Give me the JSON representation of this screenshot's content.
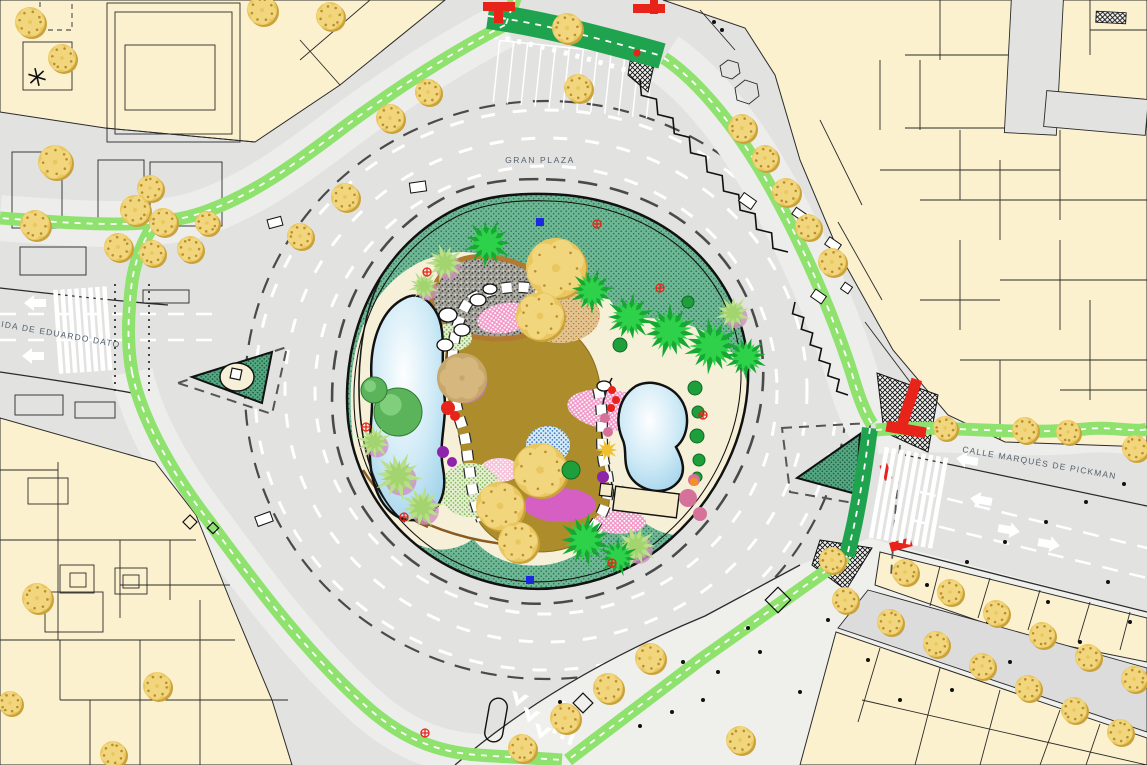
{
  "labels": {
    "roundabout": "GRAN PLAZA",
    "avenue_left": "AVENIDA DE EDUARDO DATO",
    "street_right": "CALLE MARQUÉS DE PICKMAN"
  },
  "palette": {
    "road": "#e2e2e1",
    "plaza": "#efefec",
    "building": "#fcf1cf",
    "outline": "#2a2a2a",
    "label": "#55626e",
    "bike": "#8fe26e",
    "bikeDark": "#1fa34f",
    "lawn": "#6fb896",
    "pond": "#9fd2ea",
    "pathOlive": "#ad8d2b",
    "sand": "#f7f0d8",
    "treeGold": "#eac75e",
    "palmBright": "#2ed24a",
    "palmLight": "#b9e089",
    "pink": "#f298c8",
    "magenta": "#d55fc3",
    "red": "#e8231a",
    "blue": "#1b27e0"
  },
  "features": {
    "gold_trees": [
      [
        30,
        22,
        15
      ],
      [
        62,
        58,
        14
      ],
      [
        262,
        10,
        15
      ],
      [
        330,
        16,
        14
      ],
      [
        567,
        28,
        15
      ],
      [
        578,
        88,
        14
      ],
      [
        390,
        118,
        14
      ],
      [
        428,
        92,
        13
      ],
      [
        345,
        197,
        14
      ],
      [
        300,
        236,
        13
      ],
      [
        55,
        162,
        17
      ],
      [
        35,
        225,
        15
      ],
      [
        150,
        188,
        13
      ],
      [
        135,
        210,
        15
      ],
      [
        163,
        222,
        14
      ],
      [
        118,
        247,
        14
      ],
      [
        152,
        253,
        13
      ],
      [
        190,
        249,
        13
      ],
      [
        207,
        223,
        12
      ],
      [
        742,
        128,
        14
      ],
      [
        765,
        158,
        13
      ],
      [
        786,
        192,
        14
      ],
      [
        808,
        227,
        13
      ],
      [
        832,
        262,
        14
      ],
      [
        945,
        428,
        12
      ],
      [
        1025,
        430,
        13
      ],
      [
        1068,
        432,
        12
      ],
      [
        1135,
        448,
        13
      ],
      [
        650,
        658,
        15
      ],
      [
        608,
        688,
        15
      ],
      [
        565,
        718,
        15
      ],
      [
        522,
        748,
        14
      ],
      [
        740,
        740,
        14
      ],
      [
        905,
        572,
        13
      ],
      [
        950,
        592,
        13
      ],
      [
        996,
        613,
        13
      ],
      [
        1042,
        635,
        13
      ],
      [
        1088,
        657,
        13
      ],
      [
        1134,
        679,
        13
      ],
      [
        845,
        600,
        13
      ],
      [
        890,
        622,
        13
      ],
      [
        936,
        644,
        13
      ],
      [
        982,
        666,
        13
      ],
      [
        1028,
        688,
        13
      ],
      [
        1074,
        710,
        13
      ],
      [
        1120,
        732,
        13
      ],
      [
        832,
        560,
        13
      ],
      [
        37,
        598,
        15
      ],
      [
        157,
        686,
        14
      ],
      [
        10,
        703,
        12
      ],
      [
        113,
        754,
        13
      ],
      [
        556,
        268,
        30
      ],
      [
        540,
        316,
        24
      ],
      [
        540,
        470,
        27
      ],
      [
        500,
        506,
        24
      ],
      [
        518,
        542,
        20
      ]
    ],
    "palms_bright": [
      [
        488,
        243,
        26
      ],
      [
        592,
        291,
        24
      ],
      [
        630,
        317,
        26
      ],
      [
        670,
        331,
        29
      ],
      [
        712,
        346,
        30
      ],
      [
        746,
        357,
        23
      ],
      [
        585,
        540,
        28
      ],
      [
        618,
        557,
        21
      ]
    ],
    "palms_light": [
      [
        445,
        263,
        21
      ],
      [
        424,
        286,
        17
      ],
      [
        398,
        476,
        26
      ],
      [
        422,
        507,
        23
      ],
      [
        374,
        442,
        19
      ],
      [
        636,
        546,
        23
      ],
      [
        733,
        313,
        19
      ]
    ],
    "palms_gold": [
      [
        607,
        450,
        12
      ]
    ],
    "round_trees": [
      [
        398,
        412,
        24
      ],
      [
        374,
        390,
        13
      ]
    ],
    "conifers": [
      [
        571,
        470,
        9
      ],
      [
        620,
        345,
        7
      ],
      [
        695,
        388,
        7
      ],
      [
        698,
        412,
        6
      ],
      [
        697,
        436,
        7
      ],
      [
        699,
        460,
        6
      ],
      [
        697,
        477,
        5
      ],
      [
        688,
        302,
        6
      ]
    ],
    "tan_trees": [
      [
        462,
        378,
        25
      ]
    ],
    "rose_bushes": [
      [
        688,
        498,
        9
      ],
      [
        700,
        514,
        7
      ],
      [
        694,
        480,
        6
      ],
      [
        605,
        418,
        5
      ],
      [
        608,
        432,
        5
      ]
    ],
    "red_bushes": [
      [
        612,
        390,
        4
      ],
      [
        616,
        400,
        4
      ],
      [
        611,
        408,
        4
      ],
      [
        448,
        408,
        7
      ],
      [
        455,
        416,
        5
      ]
    ],
    "purple_bushes": [
      [
        443,
        452,
        6
      ],
      [
        452,
        462,
        5
      ],
      [
        603,
        477,
        6
      ]
    ],
    "orange_dots": [
      [
        694,
        482,
        4
      ]
    ],
    "blue_markers": [
      [
        540,
        222
      ],
      [
        530,
        580
      ]
    ],
    "red_cross_markers": [
      [
        427,
        272
      ],
      [
        597,
        224
      ],
      [
        660,
        288
      ],
      [
        404,
        517
      ],
      [
        612,
        563
      ],
      [
        366,
        427
      ],
      [
        425,
        733
      ],
      [
        703,
        415
      ]
    ],
    "bollards": [
      [
        525,
        744
      ],
      [
        560,
        702
      ],
      [
        612,
        692
      ],
      [
        640,
        726
      ],
      [
        683,
        662
      ],
      [
        703,
        700
      ],
      [
        760,
        652
      ],
      [
        800,
        692
      ],
      [
        828,
        620
      ],
      [
        868,
        660
      ],
      [
        900,
        700
      ],
      [
        932,
        642
      ],
      [
        952,
        690
      ],
      [
        988,
        622
      ],
      [
        1010,
        662
      ],
      [
        1048,
        602
      ],
      [
        1080,
        642
      ],
      [
        1108,
        582
      ],
      [
        1130,
        622
      ],
      [
        927,
        585
      ],
      [
        967,
        562
      ],
      [
        1005,
        542
      ],
      [
        1046,
        522
      ],
      [
        1086,
        502
      ],
      [
        1124,
        484
      ],
      [
        748,
        628
      ],
      [
        718,
        672
      ],
      [
        672,
        712
      ],
      [
        714,
        22
      ],
      [
        722,
        30
      ]
    ],
    "diamonds": [
      [
        583,
        703,
        7
      ],
      [
        778,
        600,
        9
      ],
      [
        190,
        522,
        5
      ],
      [
        213,
        528,
        4
      ]
    ],
    "kiosks": [
      [
        740,
        196,
        15,
        10,
        35
      ],
      [
        793,
        210,
        12,
        8,
        35
      ],
      [
        826,
        240,
        14,
        9,
        35
      ],
      [
        812,
        292,
        13,
        9,
        35
      ],
      [
        842,
        284,
        9,
        8,
        35
      ],
      [
        268,
        218,
        14,
        9,
        -15
      ],
      [
        410,
        182,
        16,
        10,
        -8
      ],
      [
        256,
        514,
        16,
        10,
        -20
      ]
    ],
    "zigzags": [
      {
        "x1": 640,
        "y1": 80,
        "x2": 788,
        "y2": 252,
        "n": 9,
        "a": 9
      },
      {
        "x1": 795,
        "y1": 302,
        "x2": 848,
        "y2": 395,
        "n": 6,
        "a": 8
      }
    ],
    "zebras": [
      {
        "cx": 84,
        "cy": 330,
        "rot": -4,
        "n": 8,
        "len": 84,
        "gap": 7
      },
      {
        "cx": 910,
        "cy": 498,
        "rot": 10,
        "n": 9,
        "len": 92,
        "gap": 7.5
      }
    ],
    "palm_glyphs": [
      [
        37,
        77
      ]
    ]
  }
}
